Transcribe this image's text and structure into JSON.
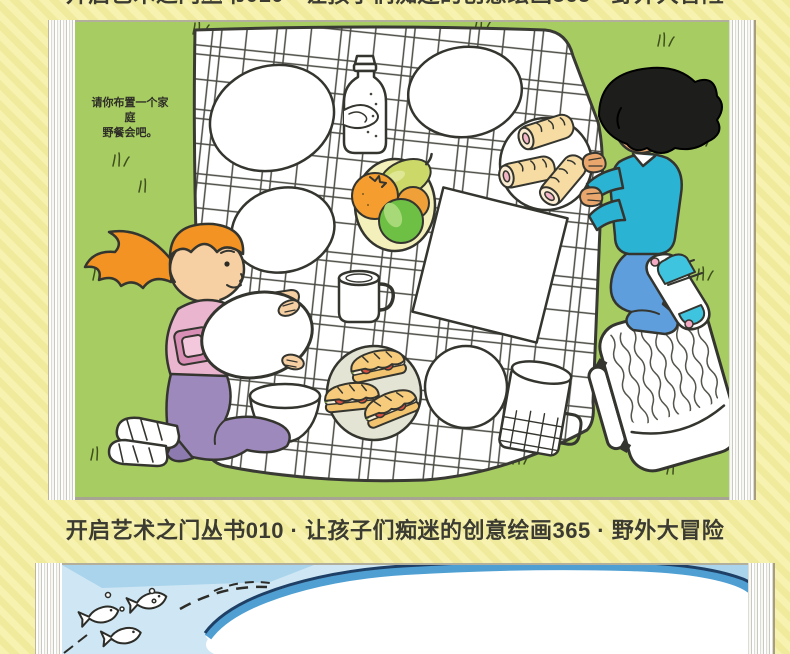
{
  "book_title": "开启艺术之门丛书010 · 让孩子们痴迷的创意绘画365 · 野外大冒险",
  "top_page": {
    "prompt_line1": "请你布置一个家庭",
    "prompt_line2": "野餐会吧。",
    "scene_items": [
      "picnic-blanket",
      "oval-plate",
      "water-bottle",
      "fruit-bowl",
      "napkin",
      "mug",
      "serving-bowl",
      "sandwich-plate",
      "round-plate",
      "thermos",
      "bread-rolls-plate",
      "picnic-basket",
      "girl-figure",
      "boy-figure",
      "grass-tuft"
    ]
  },
  "bottom_page": {
    "scene_items": [
      "fish",
      "bubbles",
      "wave-shapes",
      "whale-outline"
    ]
  },
  "colors": {
    "background_yellow": "#f7f2b0",
    "background_stripe": "#f0ea9d",
    "title_text": "#3b3b32",
    "page_green": "#a7cc62",
    "page_blue": "#cfe7f4",
    "water_dark": "#aad4ec",
    "water_band": "#4f9fd2",
    "water_outline": "#1f4066",
    "girl_hair": "#f29324",
    "girl_shirt": "#eab5cf",
    "girl_pants": "#9d89bb",
    "boy_shirt": "#2bb3d4",
    "boy_jeans": "#5f9edc",
    "orange_fruit": "#f59d2e",
    "apple_fruit": "#6dc044",
    "pear_fruit": "#ccd968",
    "bread_tan": "#f3c46f"
  }
}
